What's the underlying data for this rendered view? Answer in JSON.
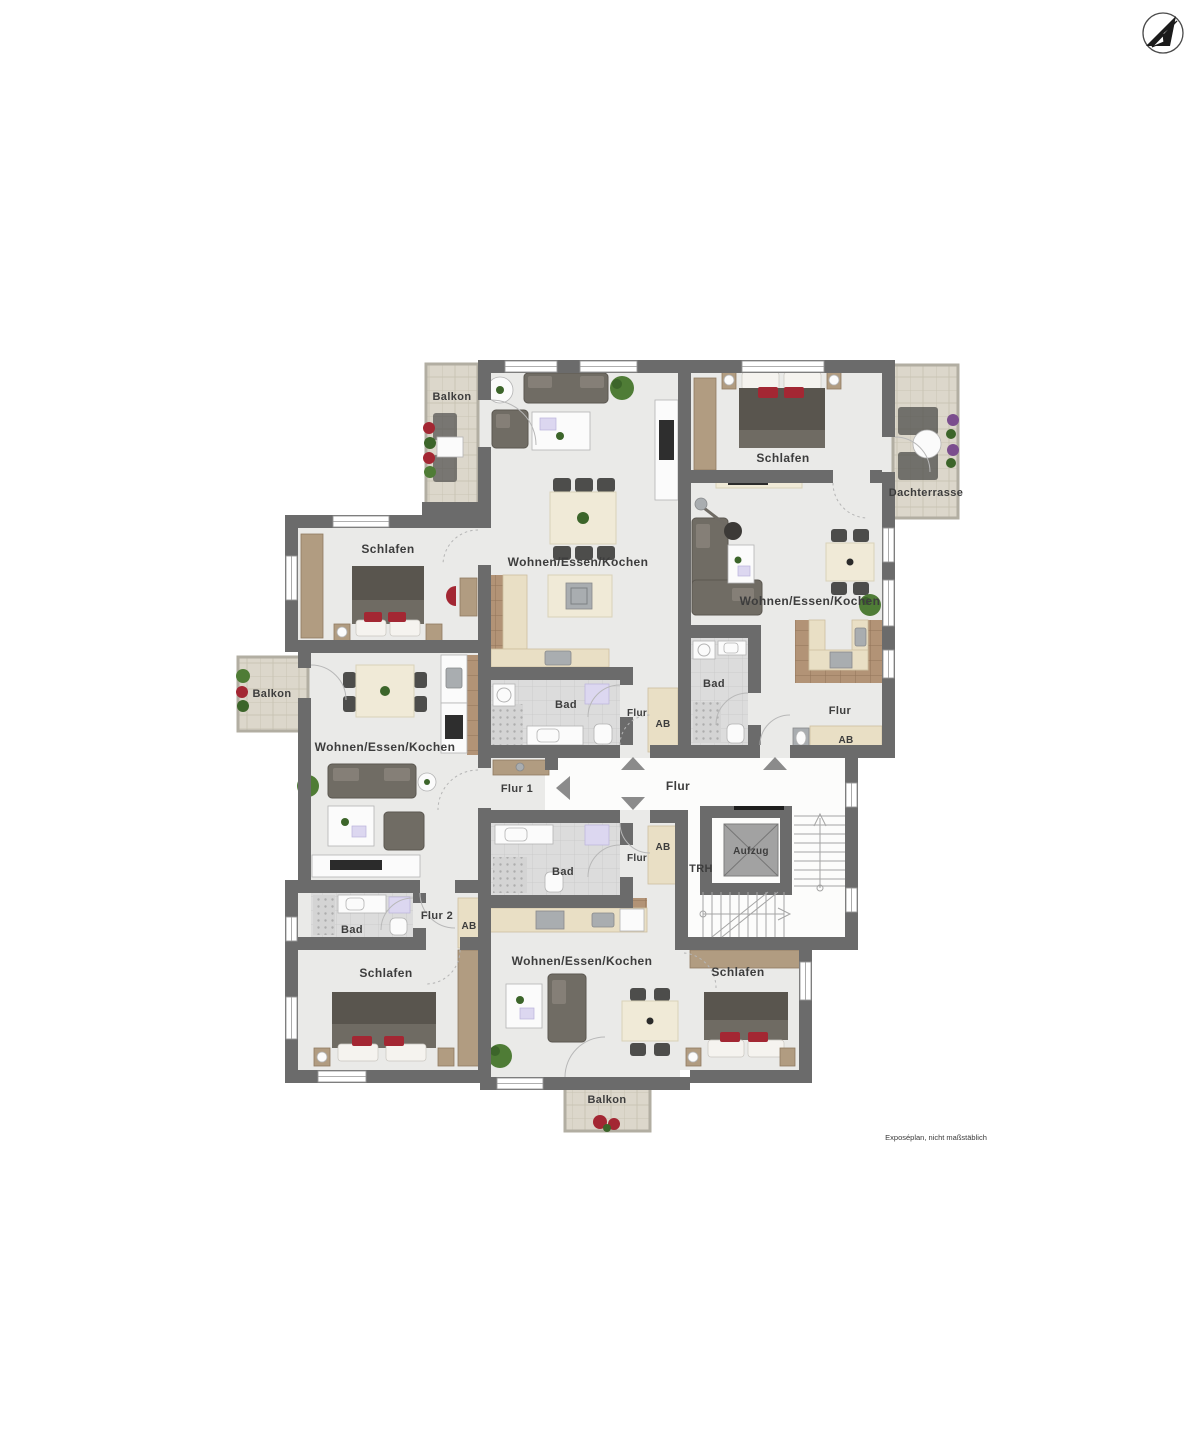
{
  "title": "Exposéplan floor plan",
  "colors": {
    "wall": "#6b6b6b",
    "room_floor": "#eaeae8",
    "corridor_floor": "#fcfcfb",
    "balcony_floor": "#dcd7cb",
    "bath_tile": "#dcdcdc",
    "kitchen_tile": "#b29376",
    "wood": "#b19c81",
    "accent_red": "#a32733",
    "plant_green": "#4f7c36"
  },
  "labels": {
    "balkon_nw": "Balkon",
    "wek_top": "Wohnen/Essen/Kochen",
    "schlafen_ne": "Schlafen",
    "dachterrasse": "Dachterrasse",
    "wek_right": "Wohnen/Essen/Kochen",
    "bad_right": "Bad",
    "flur_right": "Flur",
    "ab_right": "AB",
    "schlafen_w": "Schlafen",
    "balkon_w": "Balkon",
    "wek_left": "Wohnen/Essen/Kochen",
    "bad_top_center": "Bad",
    "flur_top_center": "Flur",
    "ab_top_center": "AB",
    "flur1": "Flur 1",
    "flur_main": "Flur",
    "aufzug": "Aufzug",
    "trh": "TRH",
    "bad_bottom_center": "Bad",
    "flur_bottom_center": "Flur",
    "ab_bottom_center": "AB",
    "flur2": "Flur 2",
    "ab_left": "AB",
    "bad_sw": "Bad",
    "schlafen_sw": "Schlafen",
    "wek_bottom": "Wohnen/Essen/Kochen",
    "schlafen_se": "Schlafen",
    "balkon_s": "Balkon",
    "disclaimer": "Exposéplan, nicht maßstäblich"
  },
  "icons": {
    "compass": "north-arrow",
    "entry_arrows": [
      "up",
      "up",
      "down",
      "left"
    ]
  }
}
